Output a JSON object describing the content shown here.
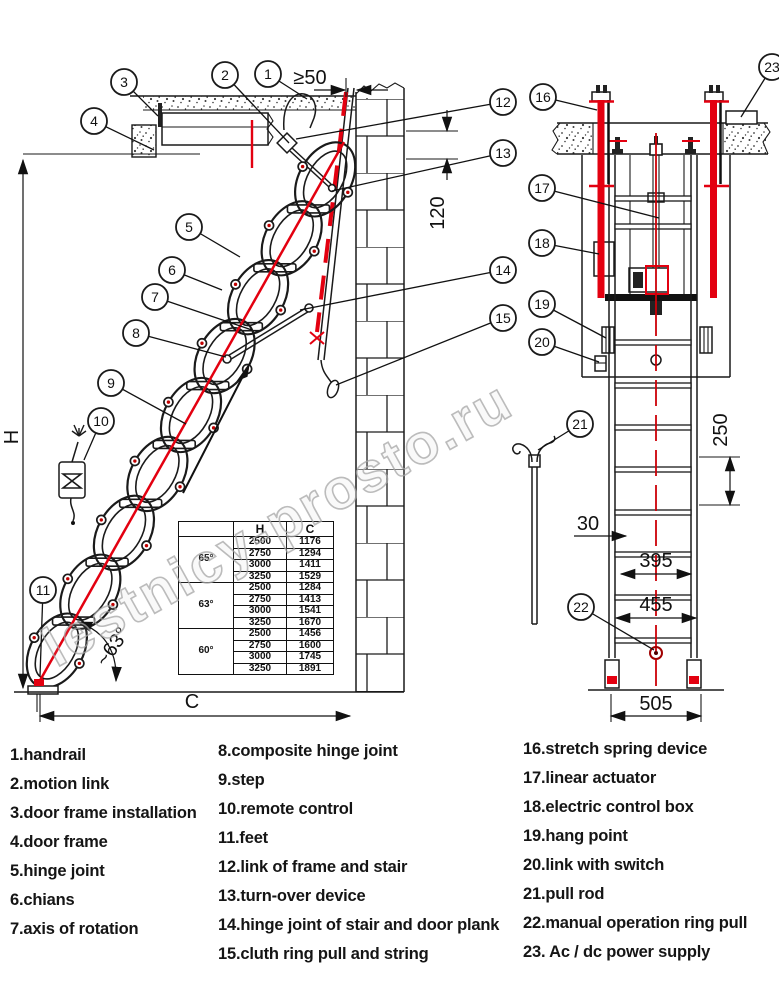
{
  "watermark": "lestnicy-prosto.ru",
  "callouts": [
    "1",
    "2",
    "3",
    "4",
    "5",
    "6",
    "7",
    "8",
    "9",
    "10",
    "11",
    "12",
    "13",
    "14",
    "15",
    "16",
    "17",
    "18",
    "19",
    "20",
    "21",
    "22",
    "23"
  ],
  "dimensions": {
    "min_gap": "≥50",
    "plank_offset": "120",
    "rung_span": "250",
    "rung_inset": "30",
    "w_inner": "395",
    "w_outer": "455",
    "w_base": "505",
    "height_label": "H",
    "width_label": "C",
    "angle": "~63°"
  },
  "table": {
    "headers": [
      "",
      "H",
      "C"
    ],
    "groups": [
      {
        "angle": "65°",
        "rows": [
          [
            "2500",
            "1176"
          ],
          [
            "2750",
            "1294"
          ],
          [
            "3000",
            "1411"
          ],
          [
            "3250",
            "1529"
          ]
        ]
      },
      {
        "angle": "63°",
        "rows": [
          [
            "2500",
            "1284"
          ],
          [
            "2750",
            "1413"
          ],
          [
            "3000",
            "1541"
          ],
          [
            "3250",
            "1670"
          ]
        ]
      },
      {
        "angle": "60°",
        "rows": [
          [
            "2500",
            "1456"
          ],
          [
            "2750",
            "1600"
          ],
          [
            "3000",
            "1745"
          ],
          [
            "3250",
            "1891"
          ]
        ]
      }
    ]
  },
  "legend": {
    "col1": [
      "1.handrail",
      "2.motion link",
      "3.door frame installation",
      "4.door frame",
      "5.hinge joint",
      "6.chians",
      "7.axis of rotation"
    ],
    "col2": [
      "8.composite hinge joint",
      "9.step",
      "10.remote control",
      "11.feet",
      "12.link of frame and stair",
      "13.turn-over device",
      "14.hinge joint of stair and door plank",
      "15.cluth ring pull and string"
    ],
    "col3": [
      "16.stretch spring device",
      "17.linear actuator",
      "18.electric control box",
      "19.hang point",
      "20.link with switch",
      "21.pull rod",
      "22.manual operation ring pull",
      "23. Ac / dc power supply"
    ]
  }
}
